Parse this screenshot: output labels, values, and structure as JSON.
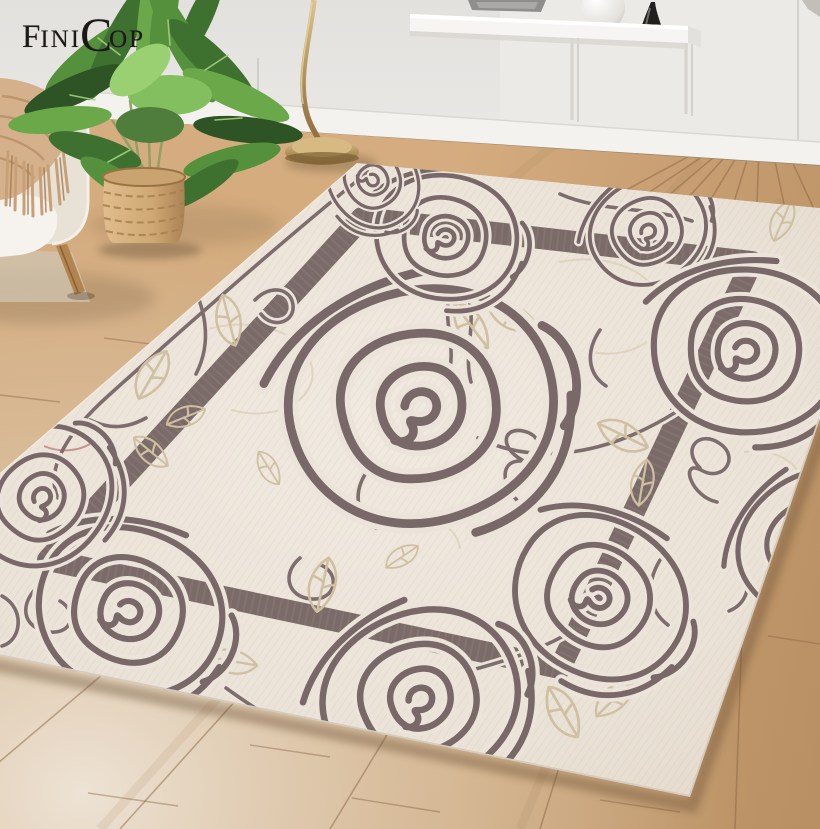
{
  "brand": {
    "name": "FiniCop",
    "logo": {
      "part1": "F",
      "part2": "INI",
      "part3": "C",
      "part4": "OP"
    }
  },
  "scene": {
    "type": "product-photo",
    "subject": "Cream area rug with hand-drawn taupe rose line-art pattern and inner border band, styled in a living room",
    "objects": [
      "beige armchair with fringed knit throw",
      "areca palm in woven basket",
      "brass floor lamp",
      "white floating shelf with sphere vase and black cone",
      "white wainscoted wall with baseboard",
      "light oak diagonal plank floor",
      "rose line-art area rug"
    ],
    "colors": {
      "wall": "#e8e6e3",
      "baseboard": "#f2f1ee",
      "floor": "#c9a173",
      "floor_seam": "#8a6745",
      "rug_base": "#ece4da",
      "rug_ink": "#786968",
      "rug_band": "#7a6b68",
      "rug_leaf_accent": "#cfc0a2",
      "red_thread": "#a8544c",
      "brass": "#b3945f",
      "basket": "#cfa873",
      "throw": "#d4b18b",
      "plant_green": "#4e7d3c",
      "logo_color": "#1b1815"
    }
  }
}
